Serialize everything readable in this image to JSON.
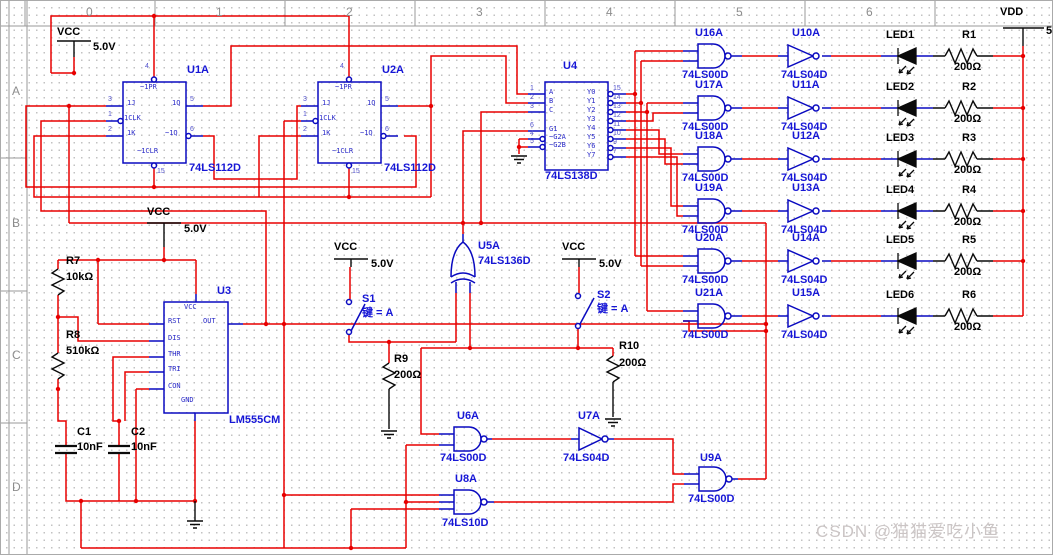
{
  "ruler": {
    "columns": [
      "0",
      "1",
      "2",
      "3",
      "4",
      "5",
      "6"
    ],
    "rows": [
      "A",
      "B",
      "C",
      "D"
    ]
  },
  "watermark": "CSDN @猫猫爱吃小鱼",
  "power": {
    "vcc": "VCC",
    "v": "5.0V",
    "vdd": "VDD",
    "vdd_net": "5"
  },
  "u1": {
    "ref": "U1A",
    "part": "74LS112D",
    "pins": {
      "pr": "~1PR",
      "j": "1J",
      "clk": "1CLK",
      "k": "1K",
      "q": "1Q",
      "qn": "~1Q",
      "clr": "~1CLR"
    },
    "nums": {
      "pr": "4",
      "j": "3",
      "clk": "1",
      "k": "2",
      "q": "5",
      "qn": "6",
      "clr": "15"
    }
  },
  "u2": {
    "ref": "U2A",
    "part": "74LS112D",
    "pins": {
      "pr": "~1PR",
      "j": "1J",
      "clk": "1CLK",
      "k": "1K",
      "q": "1Q",
      "qn": "~1Q",
      "clr": "~1CLR"
    },
    "nums": {
      "pr": "4",
      "j": "3",
      "clk": "1",
      "k": "2",
      "q": "5",
      "qn": "6",
      "clr": "15"
    }
  },
  "u4": {
    "ref": "U4",
    "part": "74LS138D",
    "left": [
      {
        "n": "A",
        "p": "1"
      },
      {
        "n": "B",
        "p": "2"
      },
      {
        "n": "C",
        "p": "3"
      },
      {
        "n": "G1",
        "p": "6"
      },
      {
        "n": "~G2A",
        "p": "4"
      },
      {
        "n": "~G2B",
        "p": "5"
      }
    ],
    "right": [
      {
        "n": "Y0",
        "p": "15"
      },
      {
        "n": "Y1",
        "p": "14"
      },
      {
        "n": "Y2",
        "p": "13"
      },
      {
        "n": "Y3",
        "p": "12"
      },
      {
        "n": "Y4",
        "p": "11"
      },
      {
        "n": "Y5",
        "p": "10"
      },
      {
        "n": "Y6",
        "p": "9"
      },
      {
        "n": "Y7",
        "p": "7"
      }
    ]
  },
  "u3": {
    "ref": "U3",
    "part": "LM555CM",
    "pins": {
      "vcc": "VCC",
      "gnd": "GND",
      "rst": "RST",
      "dis": "DIS",
      "thr": "THR",
      "tri": "TRI",
      "con": "CON",
      "out": "OUT"
    }
  },
  "u5": {
    "ref": "U5A",
    "part": "74LS136D"
  },
  "u6": {
    "ref": "U6A",
    "part": "74LS00D"
  },
  "u7": {
    "ref": "U7A",
    "part": "74LS04D"
  },
  "u8": {
    "ref": "U8A",
    "part": "74LS10D"
  },
  "u9": {
    "ref": "U9A",
    "part": "74LS00D"
  },
  "rows": [
    {
      "nand": "U16A",
      "nand_part": "74LS00D",
      "inv": "U10A",
      "inv_part": "74LS04D",
      "led": "LED1",
      "res": "R1",
      "val": "200Ω"
    },
    {
      "nand": "U17A",
      "nand_part": "74LS00D",
      "inv": "U11A",
      "inv_part": "74LS04D",
      "led": "LED2",
      "res": "R2",
      "val": "200Ω"
    },
    {
      "nand": "U18A",
      "nand_part": "74LS00D",
      "inv": "U12A",
      "inv_part": "74LS04D",
      "led": "LED3",
      "res": "R3",
      "val": "200Ω"
    },
    {
      "nand": "U19A",
      "nand_part": "74LS00D",
      "inv": "U13A",
      "inv_part": "74LS04D",
      "led": "LED4",
      "res": "R4",
      "val": "200Ω"
    },
    {
      "nand": "U20A",
      "nand_part": "74LS00D",
      "inv": "U14A",
      "inv_part": "74LS04D",
      "led": "LED5",
      "res": "R5",
      "val": "200Ω"
    },
    {
      "nand": "U21A",
      "nand_part": "74LS00D",
      "inv": "U15A",
      "inv_part": "74LS04D",
      "led": "LED6",
      "res": "R6",
      "val": "200Ω"
    }
  ],
  "r7": {
    "ref": "R7",
    "val": "10kΩ"
  },
  "r8": {
    "ref": "R8",
    "val": "510kΩ"
  },
  "r9": {
    "ref": "R9",
    "val": "200Ω"
  },
  "r10": {
    "ref": "R10",
    "val": "200Ω"
  },
  "c1": {
    "ref": "C1",
    "val": "10nF"
  },
  "c2": {
    "ref": "C2",
    "val": "10nF"
  },
  "s1": {
    "ref": "S1",
    "key": "键 = A"
  },
  "s2": {
    "ref": "S2",
    "key": "键 = A"
  }
}
